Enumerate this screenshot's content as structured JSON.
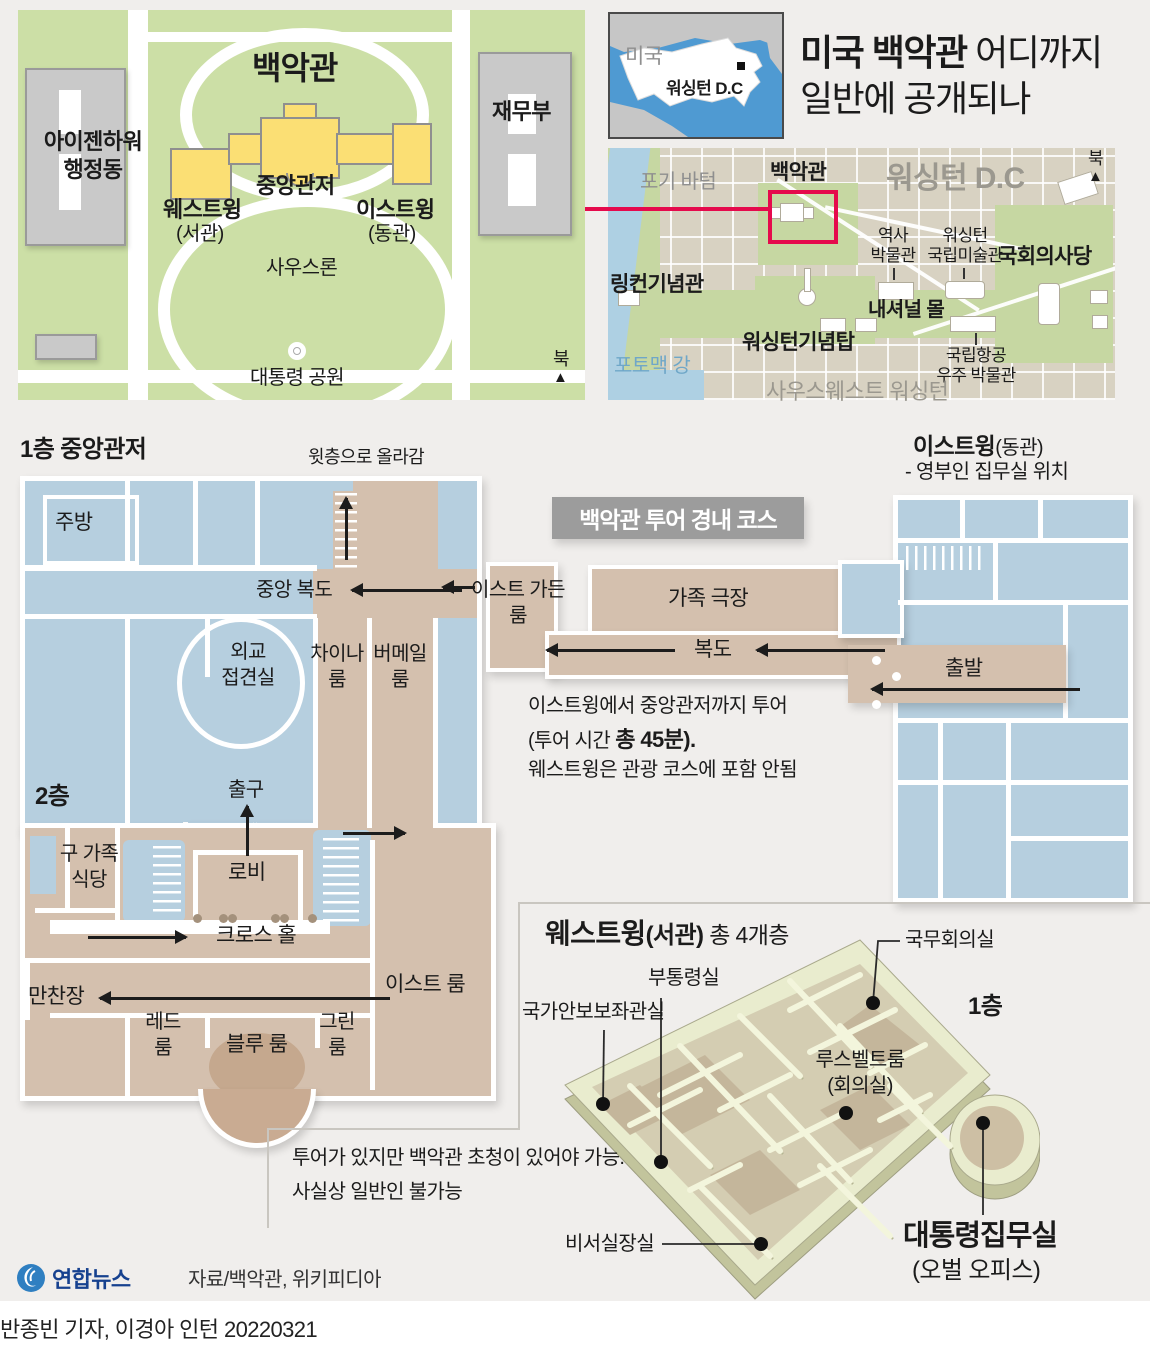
{
  "colors": {
    "bg": "#f0eeec",
    "park_green": "#ccdfa6",
    "building_gray": "#c9c9c9",
    "wh_yellow": "#fbdf74",
    "room_blue": "#b6cfdf",
    "tour_tan": "#d4c0ae",
    "oval_tan": "#c5a88e",
    "badge_gray": "#9c9c9c",
    "accent_red": "#e50a4c",
    "dc_beige": "#d8d2c2",
    "water_blue": "#aed0e3",
    "iso_olive": "#e9ecce",
    "logo_blue": "#2f7fc1"
  },
  "overview_map": {
    "title": "백악관",
    "residence": "중앙관저",
    "west_wing": "웨스트윙",
    "west_wing_sub": "(서관)",
    "east_wing": "이스트윙",
    "east_wing_sub": "(동관)",
    "eisenhower": "아이젠하워\n행정동",
    "treasury": "재무부",
    "south_lawn": "사우스론",
    "presidents_park": "대통령 공원",
    "north": "북",
    "north_arrow": "▲"
  },
  "us_inset": {
    "country": "미국",
    "city": "워싱턴 D.C"
  },
  "headline": {
    "bold": "미국 백악관",
    "line1_rest": " 어디까지",
    "line2": "일반에 공개되나"
  },
  "dc_map": {
    "foggy_bottom": "포기 바텀",
    "white_house": "백악관",
    "washington_dc": "워싱턴 D.C",
    "north": "북",
    "north_arrow": "▲",
    "history_museum": "역사\n박물관",
    "national_gallery": "워싱턴\n국립미술관",
    "capitol": "국회의사당",
    "lincoln": "링컨기념관",
    "national_mall": "내셔널 몰",
    "monument": "워싱턴기념탑",
    "air_space": "국립항공\n우주 박물관",
    "potomac": "포토맥 강",
    "southwest": "사우스웨스트 워싱턴"
  },
  "residence_f1": {
    "section_title": "1층 중앙관저",
    "kitchen": "주방",
    "up_note": "윗층으로 올라감",
    "central_hall": "중앙 복도",
    "diplomatic": "외교\n접견실",
    "china_room": "차이나\n룸",
    "vermeil_room": "버메일\n룸",
    "east_garden": "이스트 가든\n룸",
    "family_theater": "가족 극장",
    "hallway": "복도"
  },
  "tour_badge": "백악관 투어 경내 코스",
  "tour_note": {
    "line1": "이스트윙에서 중앙관저까지 투어",
    "line2_pre": "(투어 시간 ",
    "line2_bold": "총 45분).",
    "line3": "웨스트윙은 관광 코스에 포함 안됨"
  },
  "east_wing": {
    "title": "이스트윙",
    "title_sub": "(동관)",
    "subtitle": "- 영부인 집무실 위치",
    "start": "출발"
  },
  "floor2": {
    "section_title": "2층",
    "exit": "출구",
    "old_family_dining": "구 가족\n식당",
    "lobby": "로비",
    "cross_hall": "크로스 홀",
    "east_room": "이스트 룸",
    "state_dining": "만찬장",
    "red_room": "레드\n룸",
    "blue_room": "블루 룸",
    "green_room": "그린\n룸"
  },
  "west_wing": {
    "title": "웨스트윙",
    "title_sub": "(서관)",
    "title_note": "총 4개층",
    "floor": "1층",
    "cabinet_room": "국무회의실",
    "vp_office": "부통령실",
    "nsa_office": "국가안보보좌관실",
    "roosevelt_room": "루스벨트룸",
    "roosevelt_sub": "(회의실)",
    "chief_of_staff": "비서실장실",
    "oval_office": "대통령집무실",
    "oval_office_sub": "(오벌 오피스)",
    "note_line1": "투어가 있지만 백악관 초청이 있어야 가능.",
    "note_line2": "사실상 일반인 불가능"
  },
  "footer": {
    "agency": "연합뉴스",
    "source": "자료/백악관, 위키피디아",
    "credit": "반종빈 기자, 이경아 인턴  20220321"
  }
}
